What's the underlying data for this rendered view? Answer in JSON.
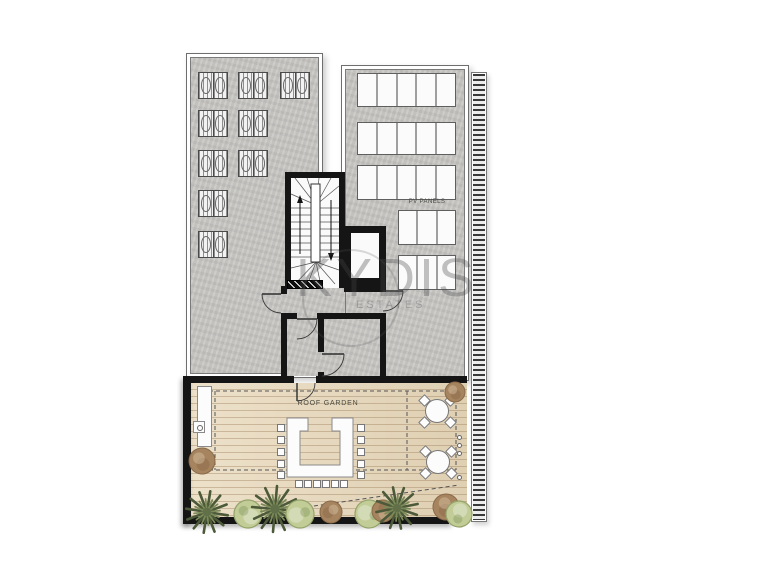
{
  "labels": {
    "pv_panels": "PV PANELS",
    "roof_garden": "ROOF GARDEN"
  },
  "watermark": {
    "line1": "KYDIS",
    "line2": "ESTATES"
  },
  "colors": {
    "wall": "#151515",
    "concrete": "#c8c7c4",
    "wood_deck": "#e8d8ba",
    "panel_white": "#fbfbfb",
    "dash_line": "#555555",
    "palm_green": "#4c5a3a",
    "palm_light": "#7b8a58",
    "bush_green": "#c1cc97",
    "plant_brown": "#a5845f"
  },
  "plan": {
    "ac_unit_size": {
      "w": 30,
      "h": 27
    },
    "ac_units": [
      [
        198,
        72
      ],
      [
        238,
        72
      ],
      [
        280,
        72
      ],
      [
        198,
        110
      ],
      [
        238,
        110
      ],
      [
        198,
        150
      ],
      [
        238,
        150
      ],
      [
        198,
        190
      ],
      [
        198,
        231
      ]
    ],
    "pv_rows": [
      {
        "x": 357,
        "y": 73,
        "w": 99,
        "h": 34,
        "cols": 5
      },
      {
        "x": 357,
        "y": 122,
        "w": 99,
        "h": 33,
        "cols": 5
      },
      {
        "x": 357,
        "y": 165,
        "w": 99,
        "h": 35,
        "cols": 5
      },
      {
        "x": 398,
        "y": 210,
        "w": 58,
        "h": 35,
        "cols": 3
      },
      {
        "x": 398,
        "y": 255,
        "w": 58,
        "h": 35,
        "cols": 3
      }
    ],
    "u_table": {
      "x": 287,
      "y": 418,
      "w": 66,
      "h": 59,
      "arm": 13,
      "hook_w": 8,
      "hook_h": 13,
      "bottom": 12
    },
    "chairs": {
      "size": 8,
      "left_x": 277,
      "right_x": 357,
      "side_ys": [
        424,
        436,
        448,
        460,
        471
      ],
      "bottom_y": 480,
      "bottom_xs": [
        295,
        304,
        313,
        322,
        331,
        340
      ]
    },
    "round_tables": [
      {
        "cx": 437,
        "cy": 411,
        "r": 12
      },
      {
        "cx": 438,
        "cy": 462,
        "r": 12
      }
    ],
    "table_chair_offsets": [
      [
        -13,
        -11
      ],
      [
        13,
        -11
      ],
      [
        -13,
        11
      ],
      [
        13,
        11
      ]
    ],
    "posts": [
      [
        459,
        389
      ],
      [
        459,
        397
      ],
      [
        459,
        437
      ],
      [
        459,
        445
      ],
      [
        459,
        453
      ],
      [
        459,
        477
      ]
    ],
    "plants": [
      {
        "type": "palm",
        "x": 207,
        "y": 512,
        "r": 21
      },
      {
        "type": "bush",
        "x": 248,
        "y": 514,
        "r": 14
      },
      {
        "type": "palm",
        "x": 275,
        "y": 509,
        "r": 23
      },
      {
        "type": "bush",
        "x": 300,
        "y": 514,
        "r": 14
      },
      {
        "type": "brown",
        "x": 331,
        "y": 512,
        "r": 11
      },
      {
        "type": "bush",
        "x": 369,
        "y": 514,
        "r": 14
      },
      {
        "type": "brown",
        "x": 383,
        "y": 511,
        "r": 11
      },
      {
        "type": "palm",
        "x": 397,
        "y": 508,
        "r": 21
      },
      {
        "type": "brown",
        "x": 446,
        "y": 507,
        "r": 13
      },
      {
        "type": "bush",
        "x": 459,
        "y": 514,
        "r": 13
      },
      {
        "type": "brown",
        "x": 202,
        "y": 461,
        "r": 13
      },
      {
        "type": "brown",
        "x": 455,
        "y": 392,
        "r": 10
      }
    ],
    "dashes": [
      [
        202,
        391,
        456,
        391
      ],
      [
        215,
        391,
        215,
        470
      ],
      [
        202,
        470,
        456,
        470
      ],
      [
        456,
        391,
        456,
        470
      ],
      [
        407,
        391,
        407,
        470
      ],
      [
        210,
        521,
        459,
        485
      ]
    ],
    "doors": [
      {
        "leaf": [
          281,
          294,
          262,
          294
        ],
        "arc": "M262,294 A19,19 0 0 0 281,313"
      },
      {
        "leaf": [
          297,
          319,
          317,
          319
        ],
        "arc": "M317,319 A20,20 0 0 1 297,339"
      },
      {
        "leaf": [
          322,
          354,
          344,
          354
        ],
        "arc": "M344,354 A22,22 0 0 1 322,376"
      },
      {
        "leaf": [
          383,
          291,
          403,
          291
        ],
        "arc": "M403,291 A20,20 0 0 1 383,311"
      },
      {
        "leaf": [
          297,
          383,
          297,
          401
        ],
        "arc": "M297,401 A18,18 0 0 0 315,383"
      }
    ],
    "bench": {
      "x": 197,
      "y": 386,
      "w": 15,
      "h": 61
    },
    "fixture": {
      "x": 193,
      "y": 421,
      "w": 12,
      "h": 12
    }
  }
}
